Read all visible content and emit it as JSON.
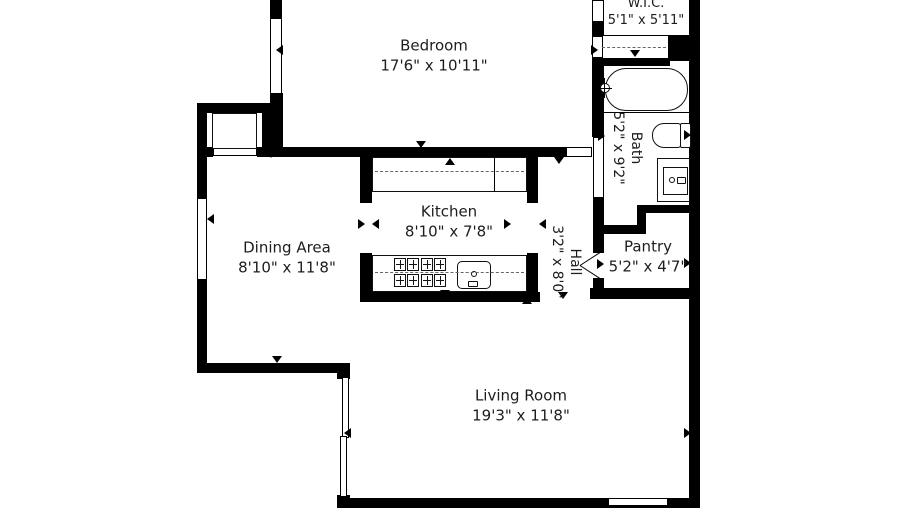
{
  "title": "Apartment floor plan",
  "colors": {
    "background": "#ffffff",
    "wall": "#000000",
    "text": "#1d1d1d",
    "fixture_line": "#111111",
    "dashed_line": "#666666"
  },
  "rooms": {
    "bedroom": {
      "name": "Bedroom",
      "dims": "17'6\" x 10'11\""
    },
    "wic": {
      "name": "W.I.C.",
      "dims": "5'1\" x 5'11\""
    },
    "bath": {
      "name": "Bath",
      "dims": "5'2\" x 9'2\""
    },
    "kitchen": {
      "name": "Kitchen",
      "dims": "8'10\" x 7'8\""
    },
    "hall": {
      "name": "Hall",
      "dims": "3'2\" x 8'0\""
    },
    "dining": {
      "name": "Dining Area",
      "dims": "8'10\" x 11'8\""
    },
    "pantry": {
      "name": "Pantry",
      "dims": "5'2\" x 4'7\""
    },
    "living": {
      "name": "Living Room",
      "dims": "19'3\" x 11'8\""
    }
  },
  "fixture_names": [
    "bathtub",
    "toilet",
    "bathroom-sink-vanity",
    "kitchen-sink",
    "stove-burners",
    "kitchen-counter",
    "closet-rod-dashed",
    "sliding-closet-door"
  ],
  "geometry": {
    "walls": [
      [
        197,
        103,
        10,
        270
      ],
      [
        197,
        103,
        86,
        10
      ],
      [
        262,
        103,
        21,
        54
      ],
      [
        270,
        0,
        12,
        20
      ],
      [
        270,
        93,
        13,
        64
      ],
      [
        197,
        147,
        16,
        10
      ],
      [
        257,
        147,
        309,
        10
      ],
      [
        360,
        147,
        12,
        56
      ],
      [
        360,
        253,
        12,
        49
      ],
      [
        527,
        147,
        11,
        56
      ],
      [
        527,
        253,
        11,
        49
      ],
      [
        360,
        292,
        180,
        10
      ],
      [
        197,
        363,
        153,
        10
      ],
      [
        337,
        363,
        13,
        16
      ],
      [
        337,
        495,
        13,
        13
      ],
      [
        337,
        498,
        363,
        10
      ],
      [
        689,
        0,
        11,
        508
      ],
      [
        668,
        35,
        21,
        26
      ],
      [
        592,
        22,
        12,
        14
      ],
      [
        592,
        58,
        12,
        79
      ],
      [
        592,
        58,
        78,
        8
      ],
      [
        593,
        198,
        11,
        39
      ],
      [
        593,
        234,
        11,
        19
      ],
      [
        593,
        278,
        11,
        12
      ],
      [
        637,
        205,
        52,
        8
      ],
      [
        637,
        205,
        9,
        29
      ],
      [
        593,
        225,
        53,
        9
      ],
      [
        590,
        288,
        100,
        11
      ]
    ],
    "windows": [
      [
        270,
        18,
        12,
        76
      ],
      [
        197,
        198,
        10,
        82
      ],
      [
        592,
        0,
        12,
        22
      ],
      [
        592,
        36,
        11,
        22
      ],
      [
        566,
        147,
        26,
        10
      ],
      [
        213,
        147,
        44,
        9
      ],
      [
        593,
        137,
        11,
        61
      ],
      [
        342,
        377,
        7,
        61
      ],
      [
        340,
        436,
        7,
        61
      ],
      [
        608,
        498,
        60,
        8
      ]
    ],
    "outlines": [
      [
        372,
        157,
        155,
        35,
        0
      ],
      [
        372,
        255,
        155,
        37,
        0
      ],
      [
        605,
        68,
        83,
        43,
        21
      ],
      [
        652,
        123,
        29,
        25,
        "12px 3px 3px 12px"
      ],
      [
        680,
        123,
        11,
        25,
        2
      ],
      [
        657,
        158,
        33,
        44,
        0
      ],
      [
        663,
        167,
        25,
        28,
        0
      ],
      [
        677,
        177,
        9,
        7,
        1
      ],
      [
        457,
        261,
        34,
        28,
        5
      ],
      [
        468,
        281,
        10,
        6,
        1
      ],
      [
        212,
        113,
        45,
        36,
        0
      ]
    ],
    "ellipses": [
      [
        669,
        177,
        6,
        6
      ],
      [
        471,
        271,
        6,
        6
      ],
      [
        600,
        83,
        10,
        10
      ]
    ],
    "lines": [
      [
        494,
        157,
        1,
        35
      ],
      [
        604,
        112,
        85,
        1
      ],
      [
        598,
        35,
        70,
        1
      ],
      [
        604,
        78,
        1,
        20
      ],
      [
        597,
        88,
        15,
        1
      ]
    ],
    "dashes": [
      [
        375,
        171,
        149
      ],
      [
        375,
        272,
        149
      ],
      [
        602,
        47,
        64
      ]
    ],
    "burners": [
      [
        394,
        258
      ],
      [
        407,
        258
      ],
      [
        421,
        258
      ],
      [
        434,
        258
      ],
      [
        394,
        274
      ],
      [
        407,
        274
      ],
      [
        421,
        274
      ],
      [
        434,
        274
      ]
    ],
    "rot_lines": [
      [
        580,
        265,
        24,
        -33
      ],
      [
        580,
        265,
        24,
        33
      ]
    ],
    "arrows": [
      [
        276,
        45,
        "left"
      ],
      [
        591,
        45,
        "right"
      ],
      [
        598,
        131,
        "right"
      ],
      [
        554,
        157,
        "down"
      ],
      [
        416,
        141,
        "down"
      ],
      [
        445,
        158,
        "up"
      ],
      [
        358,
        219,
        "right"
      ],
      [
        372,
        219,
        "left"
      ],
      [
        504,
        219,
        "right"
      ],
      [
        539,
        219,
        "left"
      ],
      [
        440,
        290,
        "down"
      ],
      [
        522,
        297,
        "up"
      ],
      [
        266,
        151,
        "down"
      ],
      [
        207,
        214,
        "left"
      ],
      [
        272,
        356,
        "down"
      ],
      [
        344,
        428,
        "left"
      ],
      [
        684,
        428,
        "right"
      ],
      [
        518,
        500,
        "down"
      ],
      [
        558,
        292,
        "down"
      ],
      [
        684,
        258,
        "right"
      ],
      [
        654,
        288,
        "down"
      ],
      [
        597,
        259,
        "right"
      ],
      [
        630,
        50,
        "down"
      ],
      [
        684,
        130,
        "right"
      ]
    ]
  }
}
